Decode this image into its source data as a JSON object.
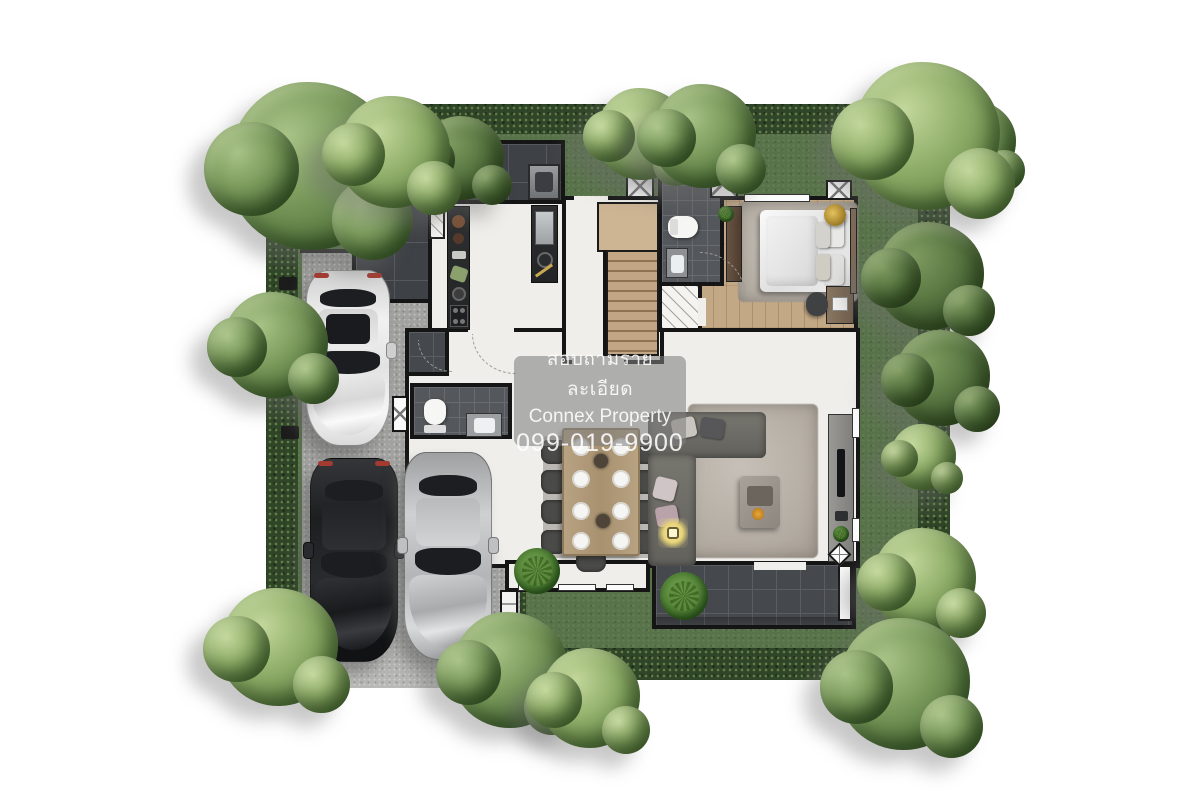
{
  "watermark": {
    "line1": "สอบถามรายละเอียด",
    "line2": "Connex Property",
    "line3": "099-019-9900"
  },
  "palette": {
    "canvas": "#ffffff",
    "lawn": "#587349",
    "hedge": "#2f4527",
    "driveway": "#a2a2a0",
    "terrace_tile": "#3e4145",
    "interior_floor": "#efeeea",
    "bedroom_wood": "#c3a886",
    "stair_wood": "#c2a584",
    "wall": "#151515",
    "living_rug": "#b2aba1",
    "sofa": "#6e6d69",
    "watermark_bg": "rgba(128,128,128,0.58)"
  },
  "scene": {
    "type": "3d-rendered ground-floor plan of a detached house with garden",
    "cars": [
      {
        "color": "white"
      },
      {
        "color": "black"
      },
      {
        "color": "silver"
      }
    ],
    "dining_seats": 9,
    "trees": 16,
    "rooms": [
      "service-terrace",
      "kitchen",
      "stair-hall",
      "bathroom",
      "bedroom",
      "closet",
      "powder-room",
      "entry",
      "dining-area",
      "living-room",
      "rear-terrace",
      "driveway-garage",
      "garden"
    ]
  }
}
